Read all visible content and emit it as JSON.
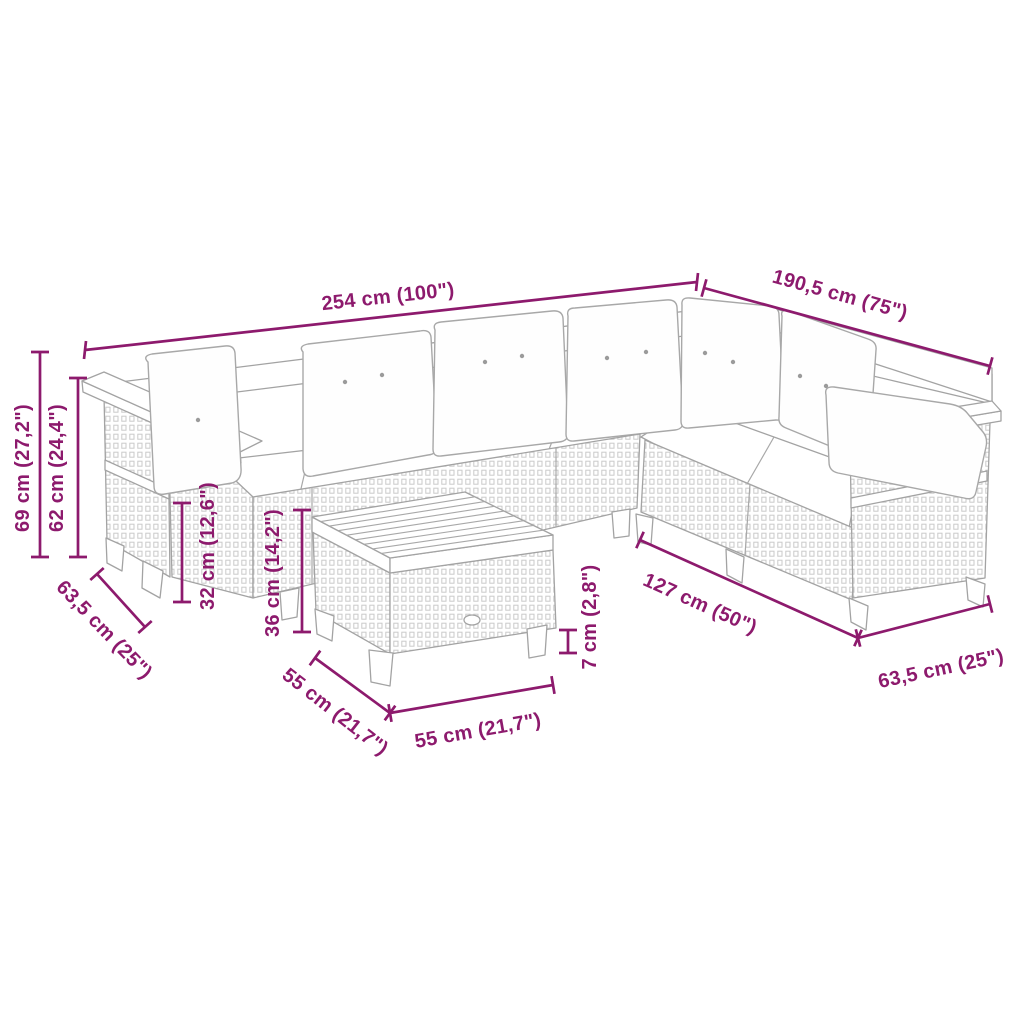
{
  "diagram": {
    "type": "product-dimension-diagram",
    "subject": "rattan-corner-lounge-set-with-table",
    "accent_color": "#8d1a6d",
    "outline_color": "#a3a3a3",
    "background_color": "#ffffff",
    "dimensions": {
      "total_length": "254 cm (100\")",
      "total_depth": "190,5 cm (75\")",
      "back_height": "69 cm (27,2\")",
      "arm_height": "62 cm (24,4\")",
      "seat_height": "32 cm (12,6\")",
      "table_height": "36 cm (14,2\")",
      "module_depth_left": "63,5 cm (25\")",
      "table_depth": "55 cm (21,7\")",
      "table_width": "55 cm (21,7\")",
      "table_leg_height": "7 cm (2,8\")",
      "right_section_length": "127 cm (50\")",
      "module_depth_right": "63,5 cm (25\")"
    }
  }
}
